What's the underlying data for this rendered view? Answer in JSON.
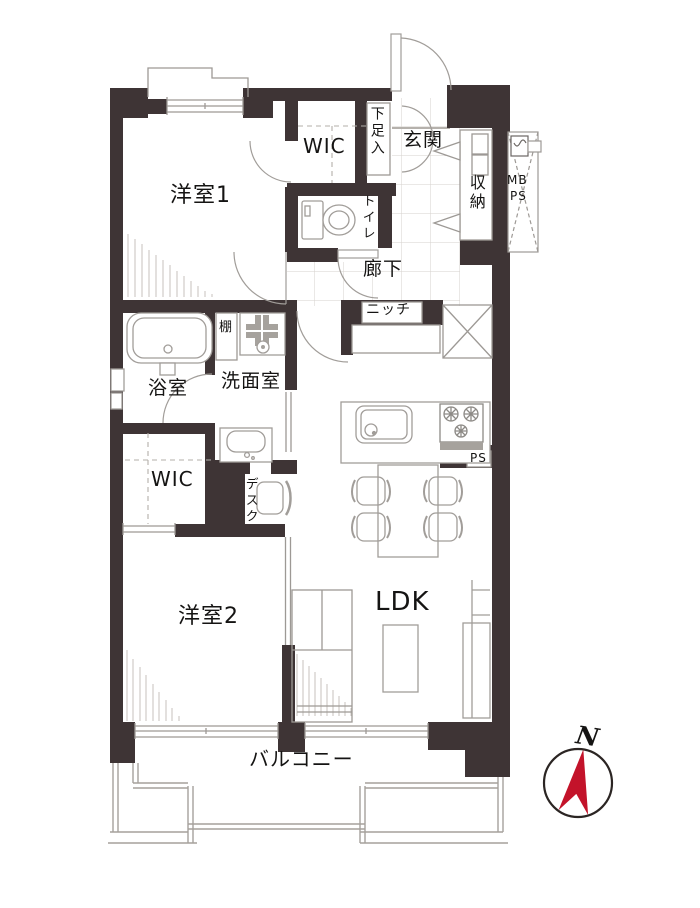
{
  "floorplan": {
    "rooms": {
      "bedroom1": "洋室1",
      "wic1": "WIC",
      "shoe_cabinet": "下足入",
      "entrance": "玄関",
      "storage": "収納",
      "mb": "MB",
      "ps_meter": "PS",
      "toilet": "トイレ",
      "hallway": "廊下",
      "niche": "ニッチ",
      "shelf": "棚",
      "bathroom": "浴室",
      "washroom": "洗面室",
      "wic2": "WIC",
      "desk": "デスク",
      "bedroom2": "洋室2",
      "ldk": "LDK",
      "ps_duct": "PS",
      "balcony": "バルコニー"
    },
    "compass": {
      "north_label": "N",
      "needle_color": "#c3132a"
    },
    "colors": {
      "wall": "#3e3435",
      "line": "#9d9995",
      "tile": "#d6d2ce",
      "hatch": "#c7c2bc"
    }
  }
}
